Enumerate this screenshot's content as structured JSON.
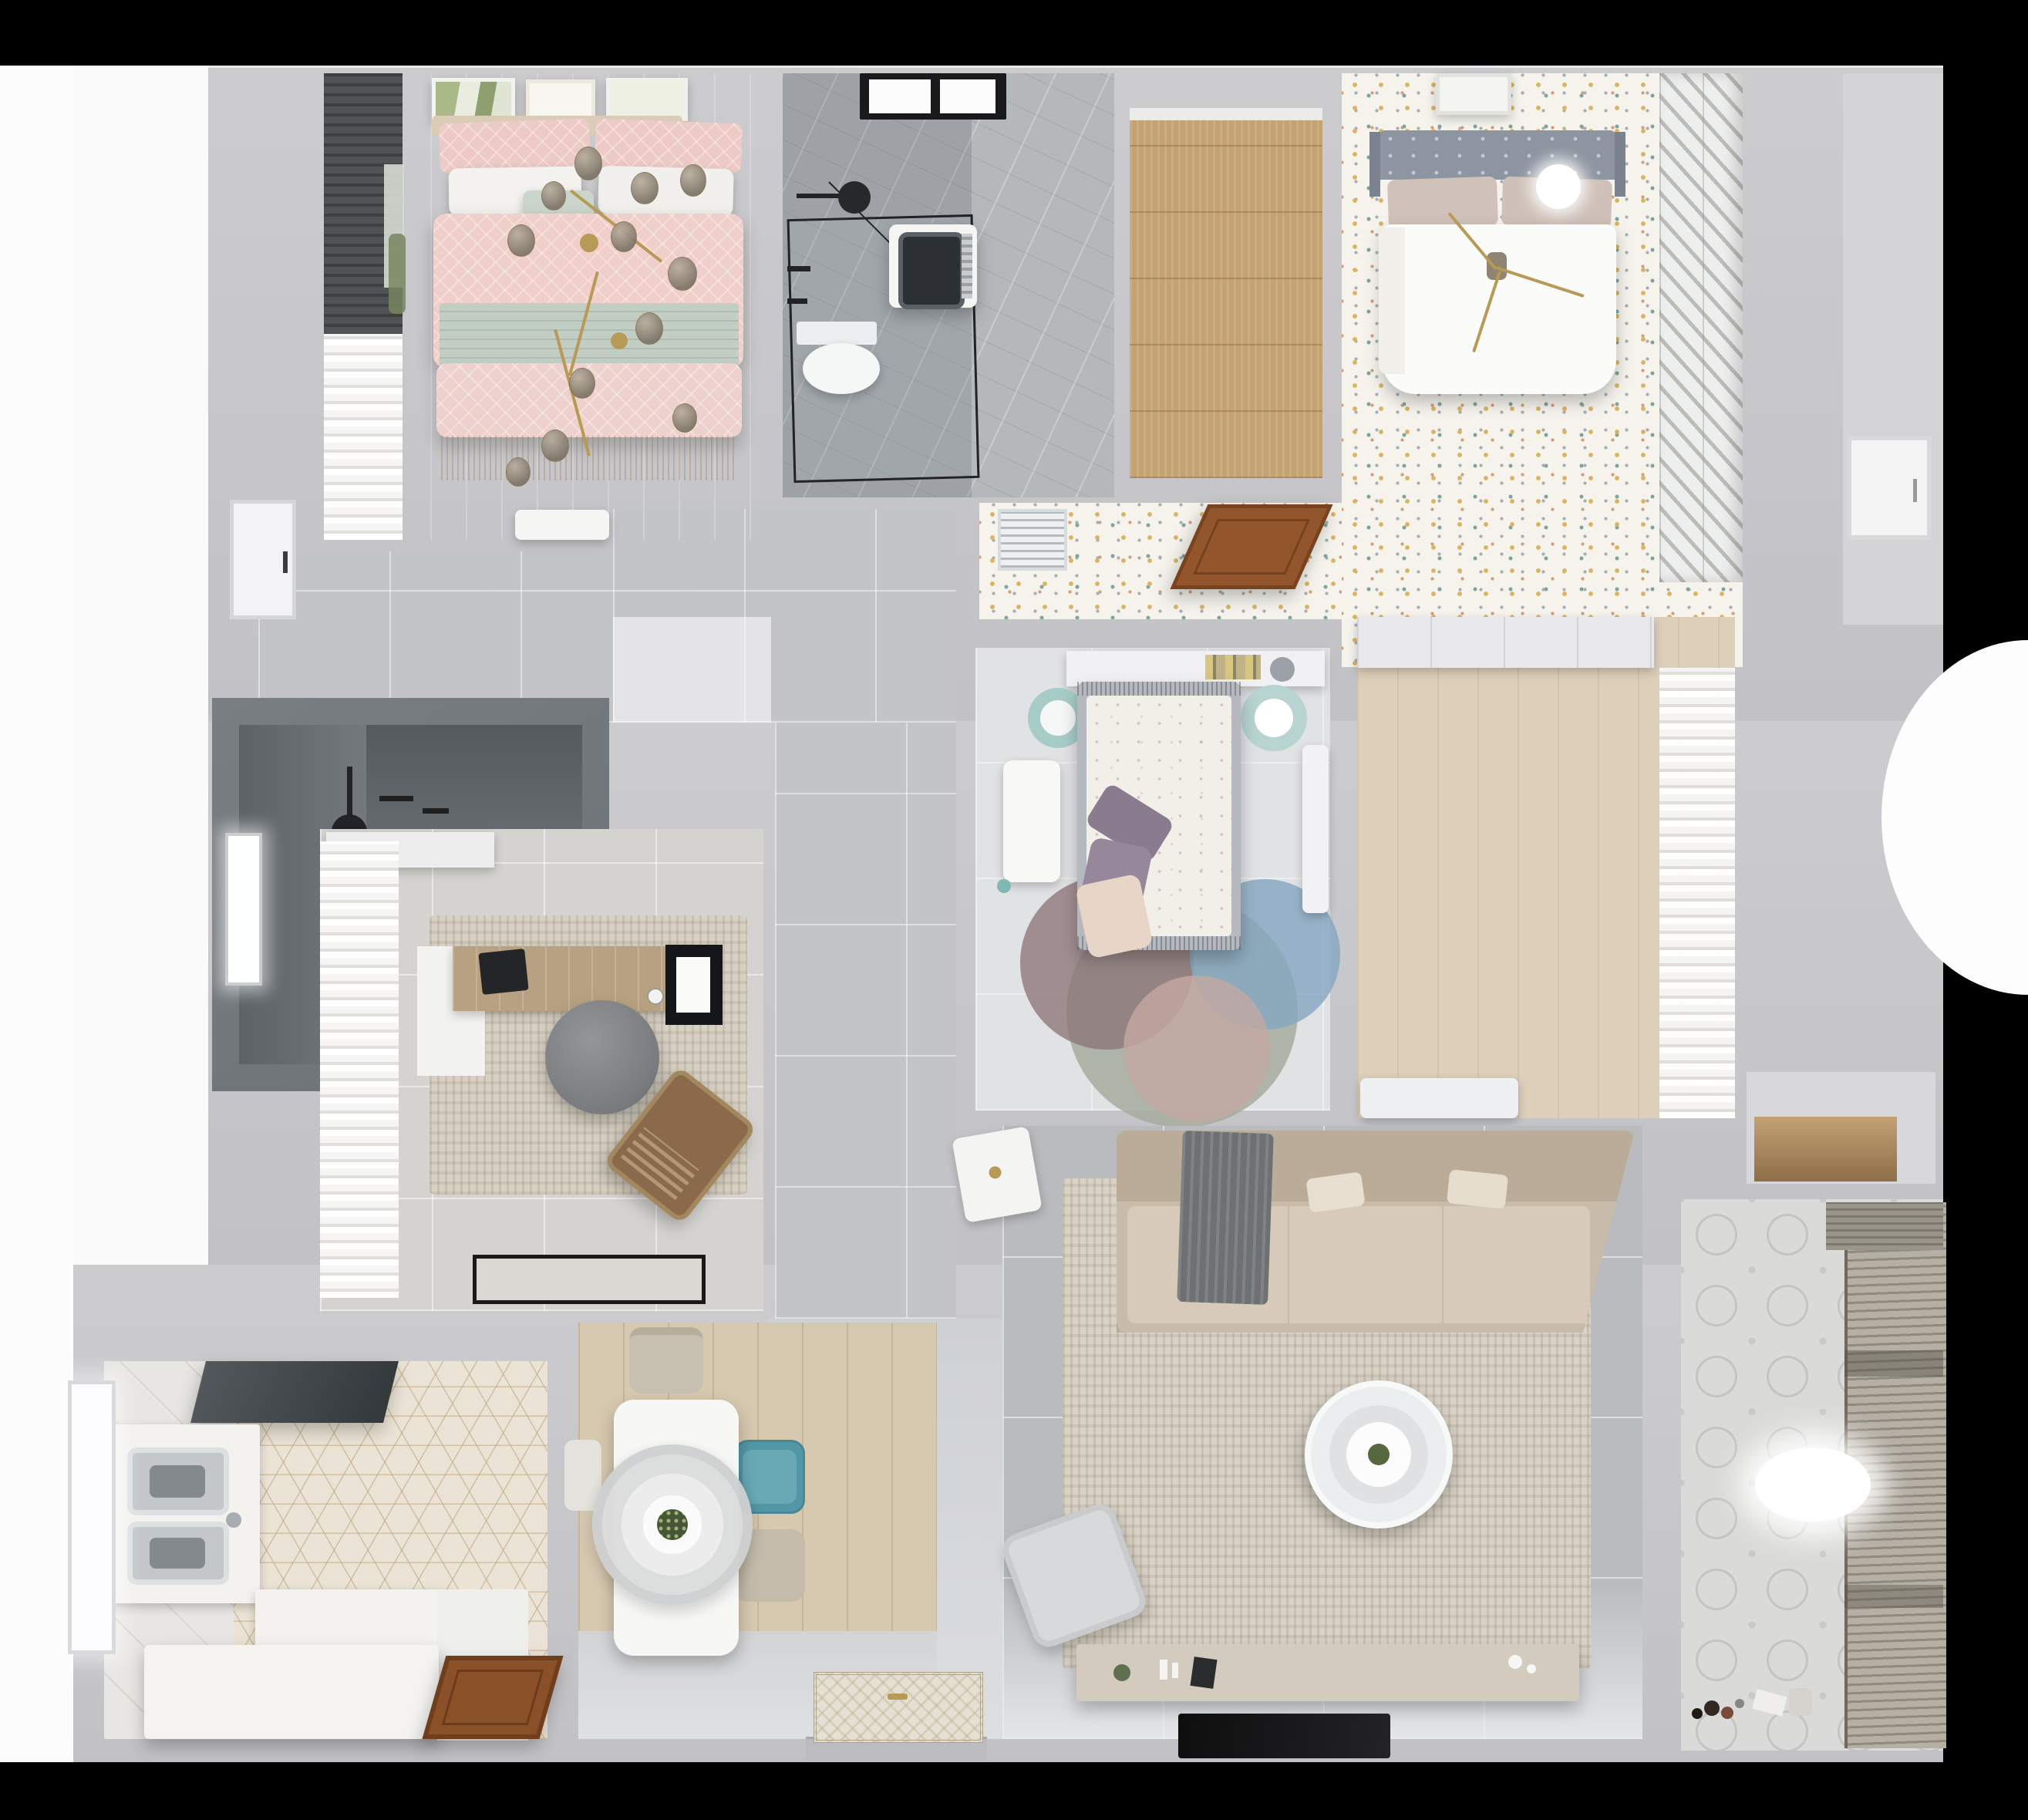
{
  "scene": {
    "title": "Apartment 3D floor plan — photoreal top-down render",
    "type": "3d-floorplan-render",
    "background": "#000000",
    "no_visible_text": true
  },
  "palette": {
    "wall_gray": "#c8c8cc",
    "hall_tile": "#c3c4c7",
    "living_tile": "#b9bbbe",
    "pink_duvet": "#f0cec9",
    "sage_blanket": "#c3cfc4",
    "confetti_base": "#f5f3ec",
    "confetti_gold": "#d9b463",
    "confetti_teal": "#7fa39e",
    "wood_light": "#d7c8b0",
    "wood_closet": "#c4a271",
    "wood_door": "#8a5129",
    "sofa_beige": "#c8bba9",
    "rug_beige": "#d9d2c5",
    "teal_chair": "#5397a6",
    "dark_fixture": "#212326",
    "headboard_gray": "#8d95a1",
    "rug_blue": "#8fb3cc",
    "rug_mauve": "#8d7579",
    "balcony_blind": "#948f84"
  },
  "rooms": [
    {
      "id": "bedroom-pink",
      "label": "Bedroom with pink bed",
      "items": [
        "three framed botanical pictures",
        "double bed with pink patterned duvet",
        "white and pink pillows",
        "sage green blanket band",
        "gold branch chandelier with smoked glass globes",
        "dark roman blinds with window",
        "white curtain",
        "white nightstand"
      ]
    },
    {
      "id": "bathroom-main",
      "label": "Main bathroom",
      "items": [
        "black framed window",
        "walk-in shower with black-framed glass",
        "ceiling shower head",
        "washing machine",
        "wall-hung toilet",
        "gray marble tile"
      ]
    },
    {
      "id": "closet-room",
      "label": "Walk-in closet room with wood floor",
      "items": [
        "empty wood plank floor"
      ]
    },
    {
      "id": "master-bedroom",
      "label": "Master bedroom",
      "items": [
        "gray tufted headboard bed with white duvet",
        "beige pillows",
        "gold chandelier",
        "framed picture",
        "white louvered wardrobe",
        "confetti patterned floor"
      ]
    },
    {
      "id": "master-corridor",
      "label": "Master suite corridor",
      "items": [
        "white AC vent grille",
        "open brown wooden door",
        "confetti patterned floor"
      ]
    },
    {
      "id": "bedroom-second",
      "label": "Second bedroom",
      "items": [
        "bed with gray frame and floral duvet",
        "purple and blush pillows",
        "headboard shelf with books",
        "two teal ring stools",
        "white desk",
        "white wardrobe",
        "overlapping circle rug in sage, mauve, blue and blush"
      ]
    },
    {
      "id": "dressing-area",
      "label": "Dressing area",
      "items": [
        "white closet band",
        "sheer white curtain",
        "low white cabinet",
        "light wood floor"
      ]
    },
    {
      "id": "bathroom-dark",
      "label": "Dark tiled shower room",
      "items": [
        "window",
        "black ceiling shower head",
        "white shower tray",
        "toilet",
        "green cabinet",
        "terrazzo floor"
      ]
    },
    {
      "id": "study",
      "label": "Home office",
      "items": [
        "white curtain wall",
        "wooden desk with laptop and monitor",
        "gray round office chair",
        "brown lounge chair",
        "mottled beige rug",
        "black-bordered doormat",
        "white shelf"
      ]
    },
    {
      "id": "hallway",
      "label": "Hallway with gray tiles",
      "items": [
        "large gray floor tiles",
        "bright lit wall"
      ]
    },
    {
      "id": "living-room",
      "label": "Living room",
      "items": [
        "L-shaped beige sofa with gray throw",
        "round two-tier white coffee table with plant",
        "large beige rug",
        "white armchair",
        "white side table",
        "TV console with decor",
        "flat black TV panel"
      ]
    },
    {
      "id": "dining-area",
      "label": "Dining area",
      "items": [
        "white rectangular table",
        "large round pendant lamp with plant centerpiece",
        "two beige chairs",
        "teal chair",
        "white chair",
        "wood plank floor"
      ]
    },
    {
      "id": "kitchen",
      "label": "Kitchen",
      "items": [
        "hexagon tile floor",
        "double stainless sink",
        "white L-shaped counters",
        "white island",
        "dark fridge",
        "brown wooden door",
        "window"
      ]
    },
    {
      "id": "balcony",
      "label": "Balcony / laundry",
      "items": [
        "patterned tile floor",
        "slatted drying blinds along window",
        "storage niche with wood shelf",
        "toys on floor",
        "watering can",
        "light glare"
      ]
    },
    {
      "id": "entry",
      "label": "Entry",
      "items": [
        "ornate doormat",
        "front door",
        "light tile floor"
      ]
    }
  ]
}
